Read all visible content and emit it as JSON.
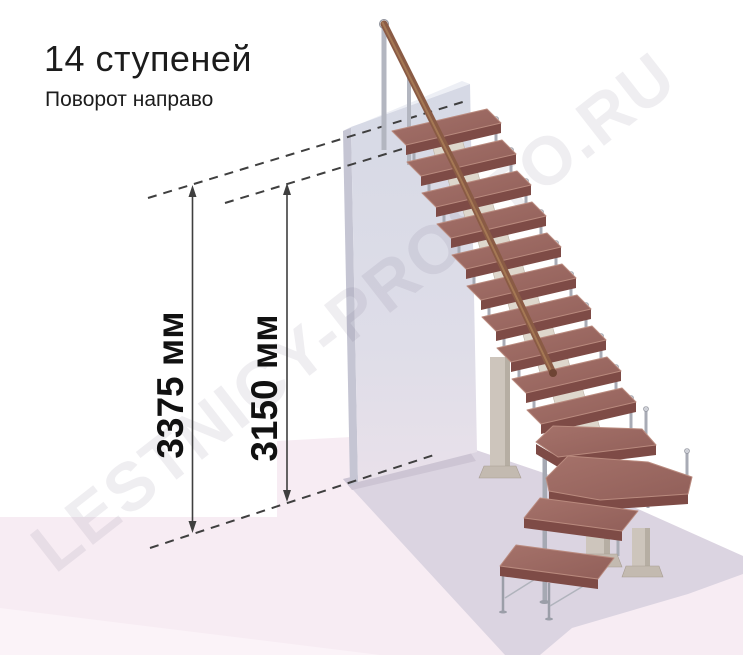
{
  "header": {
    "title": "14 ступеней",
    "subtitle": "Поворот направо"
  },
  "dimensions": {
    "left_label": "3375 мм",
    "right_label": "3150 мм"
  },
  "watermark": "LESTNICY-PROSTO.RU",
  "colors": {
    "tread_top": "#9c6862",
    "tread_front": "#7e4b46",
    "handrail": "#8a5b45",
    "metal": "#a8abb5",
    "support_beige": "#cdc5bc",
    "wall": "#d7dae5",
    "floor_pink": "#f7ecf3",
    "floor_shadow": "#dbd4e1",
    "dimension_lines": "#3f3f3f",
    "text": "#1c1c1c"
  }
}
